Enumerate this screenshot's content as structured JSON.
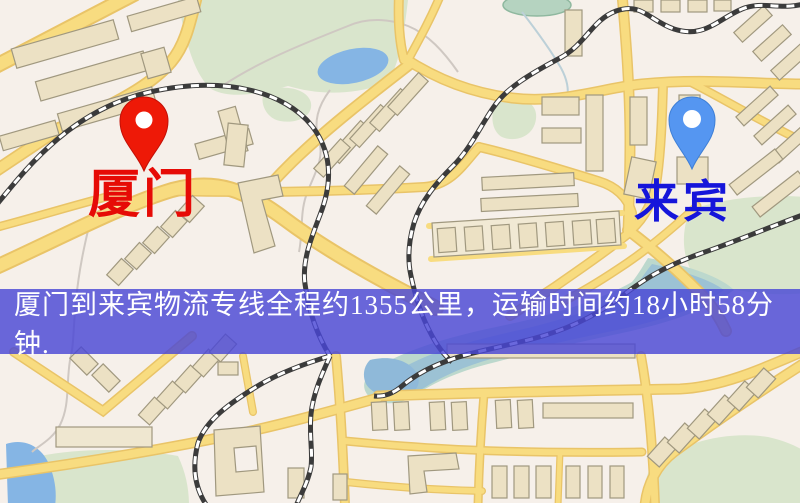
{
  "banner": {
    "text": "厦门到来宾物流专线全程约1355公里，运输时间约18小时58分钟.",
    "background_color": "#4a48d5",
    "text_color": "#ffffff"
  },
  "route": {
    "origin": "厦门",
    "destination": "来宾",
    "distance_text": "约1355公里",
    "duration_text": "约18小时58分钟"
  },
  "markers": {
    "origin": {
      "label": "厦门",
      "label_color": "#e60b06",
      "pin_color": "#ee1907",
      "icon": "map-pin-icon"
    },
    "destination": {
      "label": "来宾",
      "label_color": "#1515da",
      "pin_color": "#5596f1",
      "icon": "map-pin-icon"
    }
  },
  "map": {
    "palette": {
      "base": "#f6f0ea",
      "road_fill": "#f8dc80",
      "road_casing": "#e9c468",
      "building_fill": "#ece1c4",
      "building_outline": "#a0987f",
      "park": "#d9e5cc",
      "water": "#85b5e4",
      "river": "#9cc2d4",
      "railway_dark": "#3b3b3b",
      "railway_light": "#ffffff"
    }
  }
}
